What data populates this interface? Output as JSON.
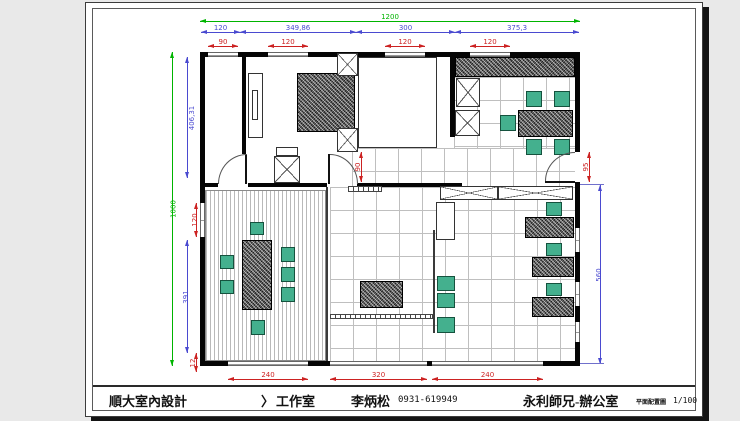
{
  "footer": {
    "company": "順大室內設計",
    "separator": "〉",
    "studio": "工作室",
    "designer": "李炳松",
    "phone": "0931-619949",
    "project": "永利師兄-辦公室",
    "sheet_label": "平面配置圖",
    "scale": "1/100"
  },
  "dims": {
    "top_overall": "1200",
    "top_segments": [
      "120",
      "349,86",
      "300",
      "375,3"
    ],
    "top_windows": [
      "90",
      "120",
      "120",
      "120"
    ],
    "left_overall": "1000",
    "left_segments": [
      "406,31",
      "391"
    ],
    "left_window": "120",
    "left_small": "12",
    "mid_door": "90",
    "right_door": "95",
    "right_segment": "560",
    "bottom_windows": [
      "240",
      "320",
      "240"
    ]
  },
  "colors": {
    "dim_green": "#00b400",
    "dim_blue": "#4a4ad0",
    "dim_red": "#cc2222",
    "furniture_teal": "#44b08e",
    "paper": "#ffffff",
    "background": "#e9e9e9"
  }
}
